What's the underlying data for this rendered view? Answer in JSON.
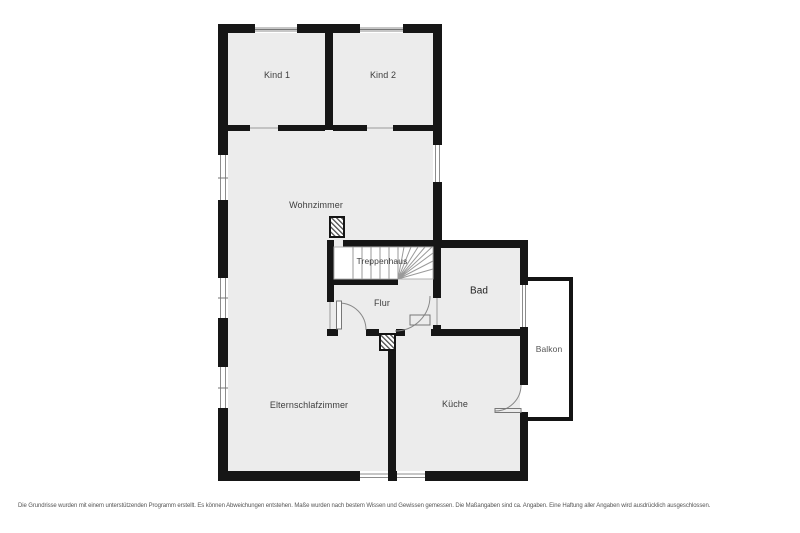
{
  "title": "Grundriss Obergeschoss",
  "colors": {
    "wall": "#161616",
    "room_fill": "#ececec",
    "stair_fill": "#ffffff",
    "window_line": "#8c8c8c",
    "label": "#3d3d3d"
  },
  "rooms": {
    "kind1": "Kind 1",
    "kind2": "Kind 2",
    "wohnzimmer": "Wohnzimmer",
    "treppenhaus": "Treppenhaus",
    "flur": "Flur",
    "bad": "Bad",
    "balkon": "Balkon",
    "elternschlafzimmer": "Elternschlafzimmer",
    "kueche": "Küche"
  },
  "footer": {
    "disclaimer": "Die Grundrisse wurden mit einem unterstützenden Programm erstellt. Es können Abweichungen entstehen. Maße wurden nach bestem Wissen und Gewissen gemessen. Die Maßangaben sind ca. Angaben. Eine Haftung aller Angaben wird ausdrücklich ausgeschlossen."
  }
}
